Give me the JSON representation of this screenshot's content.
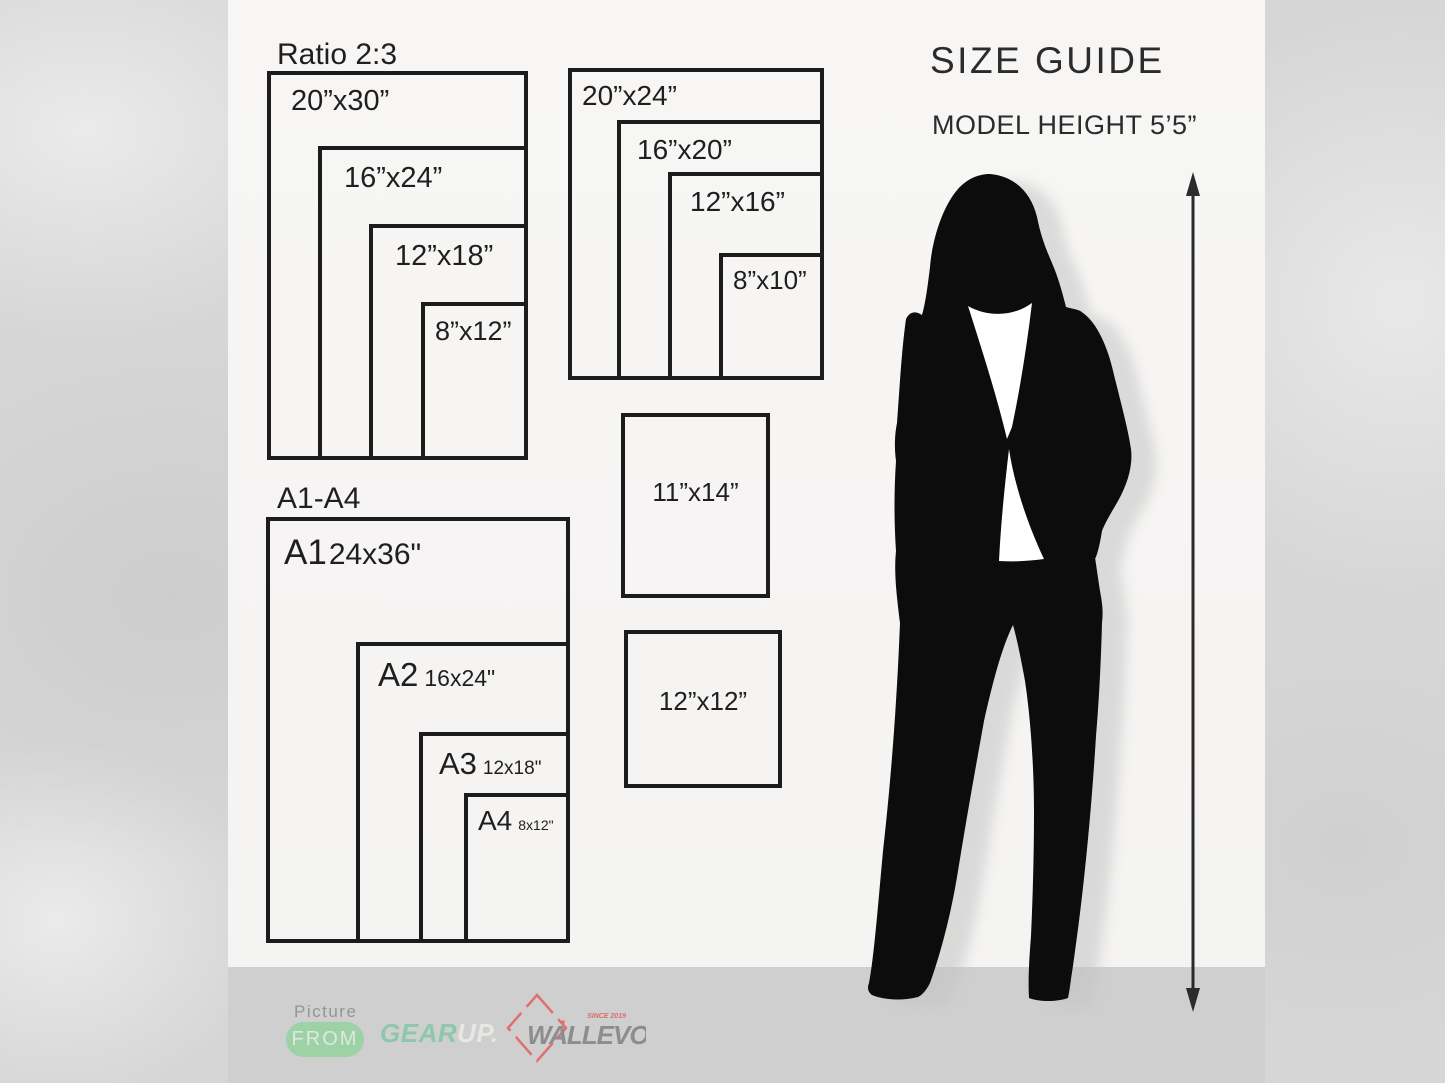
{
  "page": {
    "title": "SIZE GUIDE",
    "subtitle": "MODEL HEIGHT 5’5”"
  },
  "ratio_group": {
    "heading": "Ratio 2:3",
    "sizes": [
      "20”x30”",
      "16”x24”",
      "12”x18”",
      "8”x12”"
    ]
  },
  "standard_group": {
    "sizes": [
      "20”x24”",
      "16”x20”",
      "12”x16”",
      "8”x10”"
    ]
  },
  "singles": {
    "s11x14": "11”x14”",
    "s12x12": "12”x12”"
  },
  "a_group": {
    "heading": "A1-A4",
    "items": [
      {
        "code": "A1",
        "size": "24x36\""
      },
      {
        "code": "A2",
        "size": "16x24\""
      },
      {
        "code": "A3",
        "size": "12x18\""
      },
      {
        "code": "A4",
        "size": "8x12\""
      }
    ]
  },
  "footer": {
    "picture_label": "Picture",
    "from_label": "FROM",
    "gear": "GEAR",
    "up": "UP.",
    "brand": "WALLEVO",
    "since": "SINCE 2019"
  },
  "colors": {
    "line": "#1c1c1c",
    "accent_green": "#9dd2a6",
    "gear_teal": "#8cc7ae",
    "brand_gray": "#8d8d8d",
    "diamond_red": "#e06f6f",
    "footer_bar": "#cfcfcf"
  }
}
